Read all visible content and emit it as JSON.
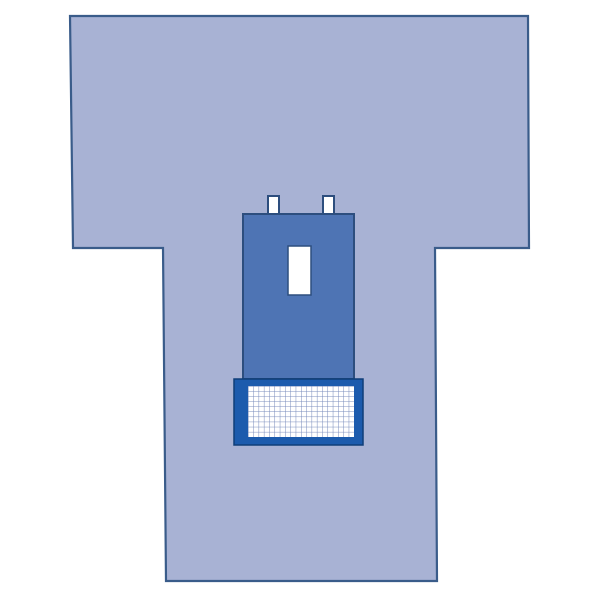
{
  "illustration": {
    "subject": "surgical-drape-schematic",
    "elements": [
      "t-shaped-drape",
      "reinforcement-panel",
      "adhesive-tab-left",
      "adhesive-tab-right",
      "fenestration-opening",
      "instrument-pouch",
      "pouch-grid-mesh"
    ]
  },
  "colors": {
    "page_background": "#ffffff",
    "drape_fill": "#a8b2d4",
    "drape_outline": "#3a5c8a",
    "panel_fill": "#4e74b4",
    "panel_outline": "#2d4e7e",
    "tab_fill": "#ffffff",
    "tab_outline": "#2d4e7e",
    "fenestration_fill": "#ffffff",
    "fenestration_outline": "#2d4e7e",
    "pouch_fill": "#1c5bad",
    "pouch_outline": "#0f3e78",
    "grid_fill": "#ffffff",
    "grid_line": "#7589ba"
  },
  "grid": {
    "columns": 20,
    "rows": 10
  }
}
